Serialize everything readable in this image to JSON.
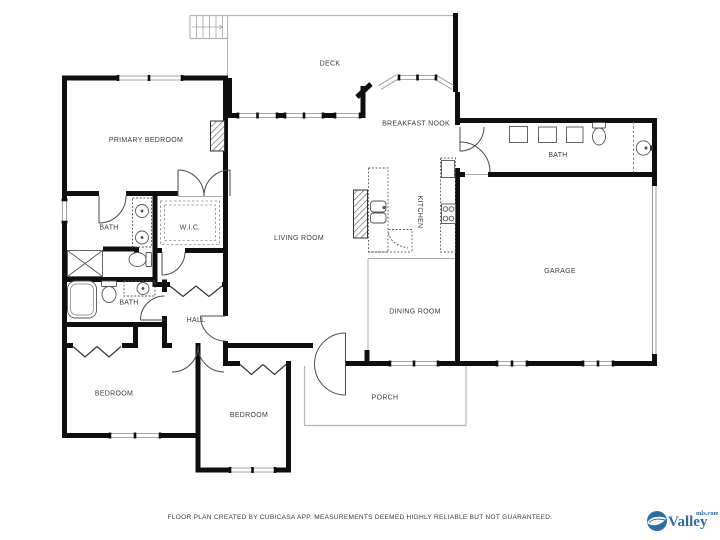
{
  "rooms": {
    "deck": "DECK",
    "primary_bedroom": "PRIMARY BEDROOM",
    "breakfast_nook": "BREAKFAST NOOK",
    "bath_top_right": "BATH",
    "kitchen": "KITCHEN",
    "living_room": "LIVING ROOM",
    "wic": "W.I.C.",
    "bath_primary": "BATH",
    "bath_hall": "BATH",
    "garage": "GARAGE",
    "dining_room": "DINING ROOM",
    "hall": "HALL",
    "bedroom_left": "BEDROOM",
    "bedroom_middle": "BEDROOM",
    "porch": "PORCH"
  },
  "footer": {
    "disclaimer": "FLOOR PLAN CREATED BY CUBICASA APP. MEASUREMENTS DEEMED HIGHLY RELIABLE BUT NOT GUARANTEED."
  },
  "logo": {
    "brand": "Valley",
    "suffix": "mls.com"
  },
  "colors": {
    "wall": "#0f0f0f",
    "label": "#3a3a3a",
    "fixture": "#555555",
    "outdoor_line": "#b5b5b5",
    "logo_blue": "#2b6da8"
  }
}
